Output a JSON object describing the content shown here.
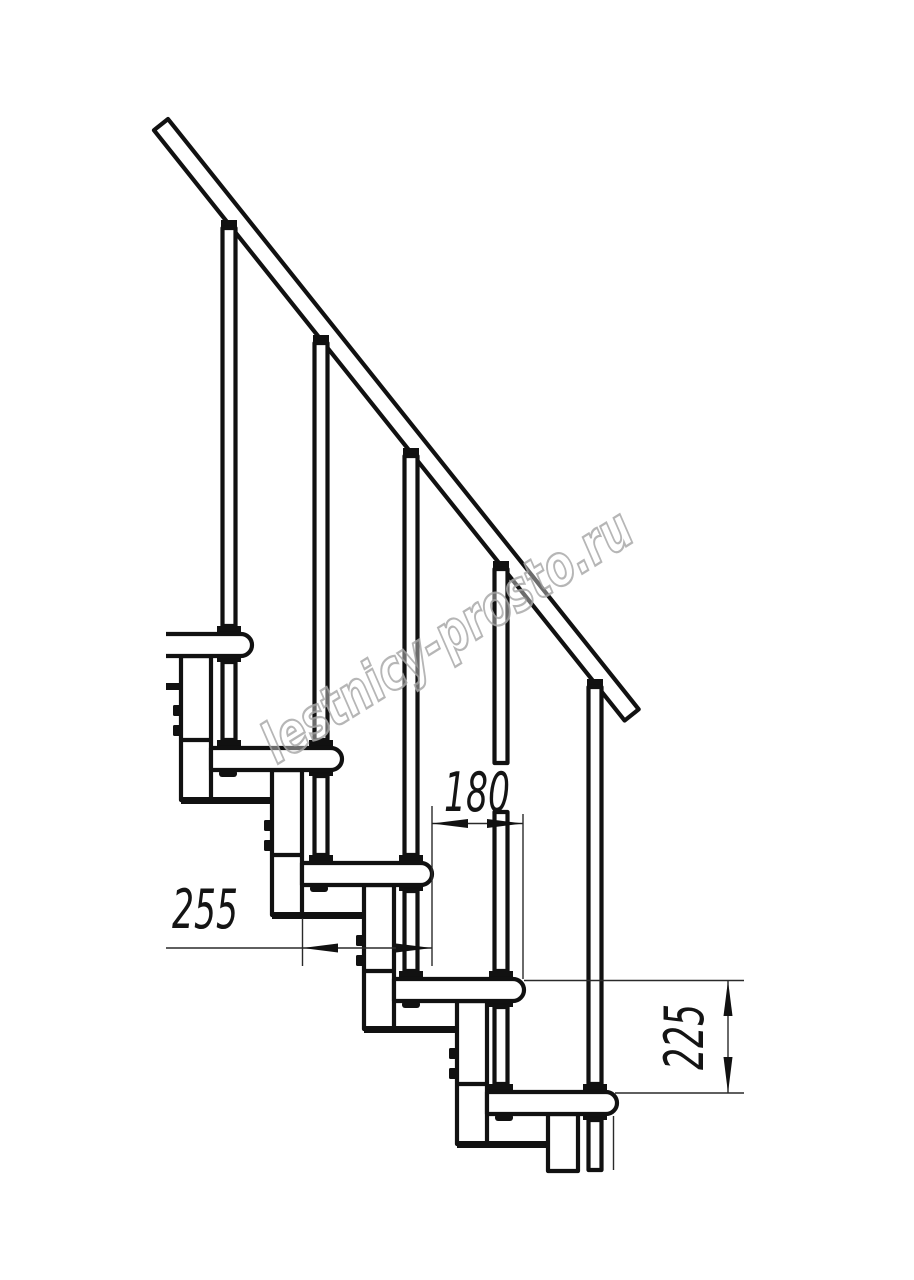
{
  "drawing": {
    "background_color": "#ffffff",
    "ink_color": "#111111",
    "thin_line_color": "#2a2a2a",
    "visible_tread_count": 5,
    "visible_baluster_count": 5
  },
  "dimensions": [
    {
      "id": "step-going",
      "label": "180"
    },
    {
      "id": "tread-depth",
      "label": "255"
    },
    {
      "id": "riser-height",
      "label": "225"
    }
  ],
  "watermark": {
    "text": "lestnicy-prosto.ru",
    "color": "#aaaaaa"
  }
}
